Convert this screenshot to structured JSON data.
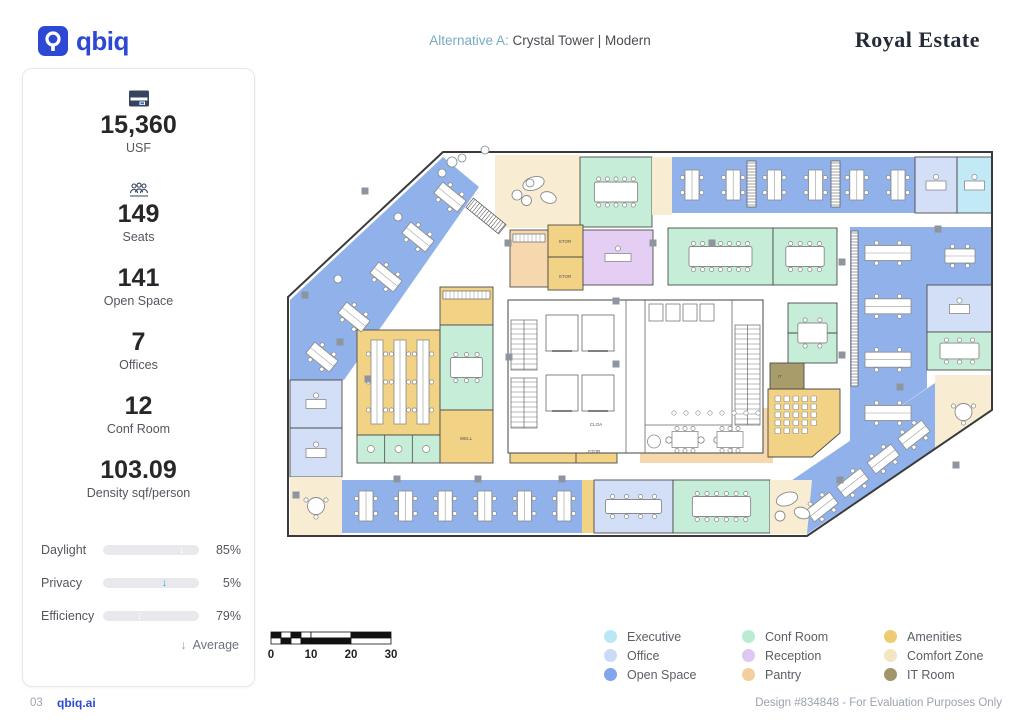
{
  "header": {
    "brand": "qbiq",
    "alt_label": "Alternative A:",
    "alt_value": "Crystal Tower | Modern",
    "client": "Royal Estate"
  },
  "stats": [
    {
      "icon": "building-icon",
      "value": "15,360",
      "label": "USF"
    },
    {
      "icon": "people-icon",
      "value": "149",
      "label": "Seats"
    },
    {
      "icon": "",
      "value": "141",
      "label": "Open Space"
    },
    {
      "icon": "",
      "value": "7",
      "label": "Offices"
    },
    {
      "icon": "",
      "value": "12",
      "label": "Conf Room"
    },
    {
      "icon": "",
      "value": "103.09",
      "label": "Density sqf/person"
    }
  ],
  "sliders": [
    {
      "label": "Daylight",
      "value": "85%",
      "pct": 85,
      "avg": 82
    },
    {
      "label": "Privacy",
      "value": "5%",
      "pct": 5,
      "avg": 64
    },
    {
      "label": "Efficiency",
      "value": "79%",
      "pct": 79,
      "avg": 38
    }
  ],
  "average_label": "Average",
  "slider_color": "#2ba8e0",
  "legend": [
    {
      "label": "Executive",
      "color": "#b9e7f5"
    },
    {
      "label": "Office",
      "color": "#cbdaf5"
    },
    {
      "label": "Open Space",
      "color": "#7fa6e9"
    },
    {
      "label": "Conf Room",
      "color": "#baecd3"
    },
    {
      "label": "Reception",
      "color": "#ddc8f3"
    },
    {
      "label": "Pantry",
      "color": "#f4cf9d"
    },
    {
      "label": "Amenities",
      "color": "#eecc74"
    },
    {
      "label": "Comfort Zone",
      "color": "#f4e6c4"
    },
    {
      "label": "IT Room",
      "color": "#a1966b"
    }
  ],
  "scalebar": {
    "labels": [
      "0",
      "10",
      "20",
      "30"
    ]
  },
  "footer": {
    "page": "03",
    "brand": "qbiq.ai",
    "note": "Design #834848 - For Evaluation Purposes Only"
  },
  "floorplan": {
    "width": 740,
    "height": 490,
    "outline": [
      [
        163,
        17
      ],
      [
        712,
        17
      ],
      [
        712,
        275
      ],
      [
        527,
        401
      ],
      [
        8,
        401
      ],
      [
        8,
        162
      ]
    ],
    "palette": {
      "open": "#91b1ea",
      "office": "#d2dff7",
      "exec": "#c2e9f6",
      "conf": "#c5edd8",
      "rec": "#e4cef4",
      "pantry": "#f7d7ad",
      "amen": "#f2d285",
      "comfort": "#f8ecd2",
      "it": "#a89c6b"
    },
    "zones": [
      {
        "c": "open",
        "p": [
          [
            163,
            22
          ],
          [
            199,
            52
          ],
          [
            64,
            245
          ],
          [
            10,
            245
          ],
          [
            10,
            165
          ]
        ],
        "f": {
          "t": "pods",
          "l": [
            42,
            222,
            170,
            62
          ],
          "n": 5,
          "a": 39
        }
      },
      {
        "c": "comfort",
        "r": [
          215,
          20,
          85,
          73
        ],
        "f": {
          "t": "lounge"
        }
      },
      {
        "c": "conf",
        "r": [
          300,
          22,
          72,
          70
        ],
        "w": 1,
        "f": {
          "t": "table",
          "s": 10
        }
      },
      {
        "c": "comfort",
        "r": [
          372,
          22,
          20,
          58
        ]
      },
      {
        "c": "open",
        "r": [
          392,
          22,
          243,
          56
        ],
        "f": {
          "t": "pods",
          "l": [
            412,
            50,
            618,
            50
          ],
          "n": 6,
          "a": 90
        }
      },
      {
        "c": "office",
        "r": [
          635,
          22,
          42,
          56
        ],
        "w": 1,
        "f": {
          "t": "desk"
        }
      },
      {
        "c": "exec",
        "r": [
          677,
          22,
          35,
          56
        ],
        "w": 1,
        "f": {
          "t": "desk"
        }
      },
      {
        "c": "pantry",
        "r": [
          230,
          95,
          38,
          57
        ],
        "w": 1,
        "f": {
          "t": "counter"
        }
      },
      {
        "c": "amen",
        "r": [
          268,
          90,
          35,
          65
        ],
        "w": 1
      },
      {
        "c": "rec",
        "r": [
          303,
          95,
          70,
          55
        ],
        "w": 1,
        "f": {
          "t": "recdesk"
        }
      },
      {
        "c": "conf",
        "r": [
          388,
          93,
          105,
          57
        ],
        "w": 1,
        "f": {
          "t": "table",
          "s": 14
        }
      },
      {
        "c": "conf",
        "r": [
          493,
          93,
          64,
          57
        ],
        "w": 1,
        "f": {
          "t": "table",
          "s": 8
        }
      },
      {
        "c": "open",
        "p": [
          [
            570,
            92
          ],
          [
            647,
            92
          ],
          [
            647,
            253
          ],
          [
            570,
            306
          ]
        ],
        "f": {
          "t": "pods",
          "l": [
            608,
            118,
            608,
            278
          ],
          "n": 4,
          "a": 0,
          "pw": 46,
          "ph": 15
        }
      },
      {
        "c": "open",
        "r": [
          647,
          92,
          65,
          58
        ],
        "f": {
          "t": "pods",
          "l": [
            680,
            121,
            680,
            121
          ],
          "n": 1,
          "a": 0
        }
      },
      {
        "c": "office",
        "r": [
          647,
          150,
          65,
          47
        ],
        "w": 1,
        "f": {
          "t": "desk"
        }
      },
      {
        "c": "conf",
        "r": [
          647,
          197,
          65,
          38
        ],
        "w": 1,
        "f": {
          "t": "table",
          "s": 6
        }
      },
      {
        "c": "comfort",
        "p": [
          [
            655,
            240
          ],
          [
            712,
            240
          ],
          [
            712,
            275
          ],
          [
            655,
            314
          ]
        ],
        "f": {
          "t": "round"
        }
      },
      {
        "c": "open",
        "p": [
          [
            496,
            356
          ],
          [
            655,
            248
          ],
          [
            655,
            314
          ],
          [
            527,
            399
          ]
        ],
        "f": {
          "t": "pods",
          "l": [
            542,
            372,
            634,
            300
          ],
          "n": 4,
          "a": -38
        }
      },
      {
        "c": "office",
        "r": [
          10,
          245,
          52,
          97
        ],
        "w": 1,
        "f": {
          "t": "desk2"
        }
      },
      {
        "c": "comfort",
        "r": [
          10,
          342,
          52,
          58
        ],
        "f": {
          "t": "round"
        }
      },
      {
        "c": "amen",
        "r": [
          77,
          195,
          83,
          105
        ],
        "w": 1,
        "f": {
          "t": "pods",
          "l": [
            97,
            247,
            143,
            247
          ],
          "n": 3,
          "a": 90,
          "pw": 84,
          "ph": 12
        }
      },
      {
        "c": "conf",
        "r": [
          77,
          300,
          83,
          28
        ],
        "w": 1,
        "f": {
          "t": "booths"
        }
      },
      {
        "c": "amen",
        "r": [
          160,
          152,
          53,
          38
        ],
        "w": 1,
        "f": {
          "t": "counter"
        }
      },
      {
        "c": "conf",
        "r": [
          160,
          190,
          53,
          85
        ],
        "w": 1,
        "f": {
          "t": "table",
          "s": 6
        }
      },
      {
        "c": "amen",
        "r": [
          160,
          275,
          53,
          53
        ],
        "w": 1
      },
      {
        "c": "amen",
        "r": [
          230,
          275,
          107,
          53
        ],
        "w": 1
      },
      {
        "c": "pantry",
        "r": [
          360,
          273,
          133,
          55
        ],
        "f": {
          "t": "tables2"
        }
      },
      {
        "c": "it",
        "r": [
          490,
          228,
          34,
          26
        ],
        "w": 1
      },
      {
        "c": "conf",
        "r": [
          508,
          168,
          49,
          60
        ],
        "w": 1,
        "f": {
          "t": "table",
          "s": 4
        }
      },
      {
        "c": "amen",
        "p": [
          [
            488,
            254
          ],
          [
            560,
            254
          ],
          [
            560,
            298
          ],
          [
            532,
            322
          ],
          [
            488,
            322
          ]
        ],
        "w": 1,
        "f": {
          "t": "chairs"
        }
      },
      {
        "c": "open",
        "r": [
          62,
          345,
          240,
          53
        ],
        "f": {
          "t": "pods",
          "l": [
            86,
            371,
            284,
            371
          ],
          "n": 6,
          "a": 90
        }
      },
      {
        "c": "amen",
        "r": [
          302,
          345,
          12,
          53
        ]
      },
      {
        "c": "office",
        "r": [
          314,
          345,
          79,
          53
        ],
        "w": 1,
        "f": {
          "t": "longtable"
        }
      },
      {
        "c": "conf",
        "r": [
          393,
          345,
          97,
          53
        ],
        "w": 1,
        "f": {
          "t": "table",
          "s": 12
        }
      },
      {
        "c": "comfort",
        "p": [
          [
            490,
            345
          ],
          [
            532,
            345
          ],
          [
            527,
            399
          ],
          [
            490,
            399
          ]
        ],
        "f": {
          "t": "lounge"
        }
      }
    ],
    "core": {
      "r": [
        228,
        165,
        255,
        153
      ]
    },
    "lines": [
      [
        268,
        122,
        303,
        122
      ],
      [
        10,
        293,
        62,
        293
      ],
      [
        296,
        275,
        296,
        328
      ],
      [
        296,
        302,
        337,
        302
      ],
      [
        508,
        198,
        557,
        198
      ],
      [
        677,
        22,
        677,
        78
      ]
    ],
    "hatches": [
      [
        467,
        26,
        9,
        46,
        0
      ],
      [
        551,
        26,
        9,
        46,
        0
      ],
      [
        571,
        96,
        7,
        155,
        0
      ],
      [
        200,
        60,
        12,
        42,
        -51
      ]
    ],
    "labels": [
      {
        "t": "STOR",
        "x": 285,
        "y": 108
      },
      {
        "t": "STOR",
        "x": 285,
        "y": 143
      },
      {
        "t": "CLOA",
        "x": 316,
        "y": 291
      },
      {
        "t": "STOR",
        "x": 314,
        "y": 318
      },
      {
        "t": "WELL",
        "x": 186,
        "y": 305
      },
      {
        "t": "IT",
        "x": 500,
        "y": 243
      }
    ],
    "columns": [
      [
        85,
        56
      ],
      [
        25,
        160
      ],
      [
        60,
        207
      ],
      [
        88,
        244
      ],
      [
        16,
        360
      ],
      [
        117,
        344
      ],
      [
        198,
        344
      ],
      [
        282,
        344
      ],
      [
        229,
        222
      ],
      [
        336,
        166
      ],
      [
        336,
        229
      ],
      [
        373,
        108
      ],
      [
        562,
        127
      ],
      [
        562,
        220
      ],
      [
        658,
        94
      ],
      [
        620,
        252
      ],
      [
        432,
        108
      ],
      [
        228,
        108
      ],
      [
        560,
        345
      ],
      [
        676,
        330
      ]
    ],
    "plants": [
      [
        172,
        27,
        5
      ],
      [
        182,
        23,
        4
      ],
      [
        162,
        38,
        4
      ],
      [
        205,
        15,
        4
      ],
      [
        118,
        82,
        4
      ],
      [
        58,
        144,
        4
      ],
      [
        237,
        60,
        5
      ],
      [
        250,
        48,
        4
      ]
    ]
  }
}
